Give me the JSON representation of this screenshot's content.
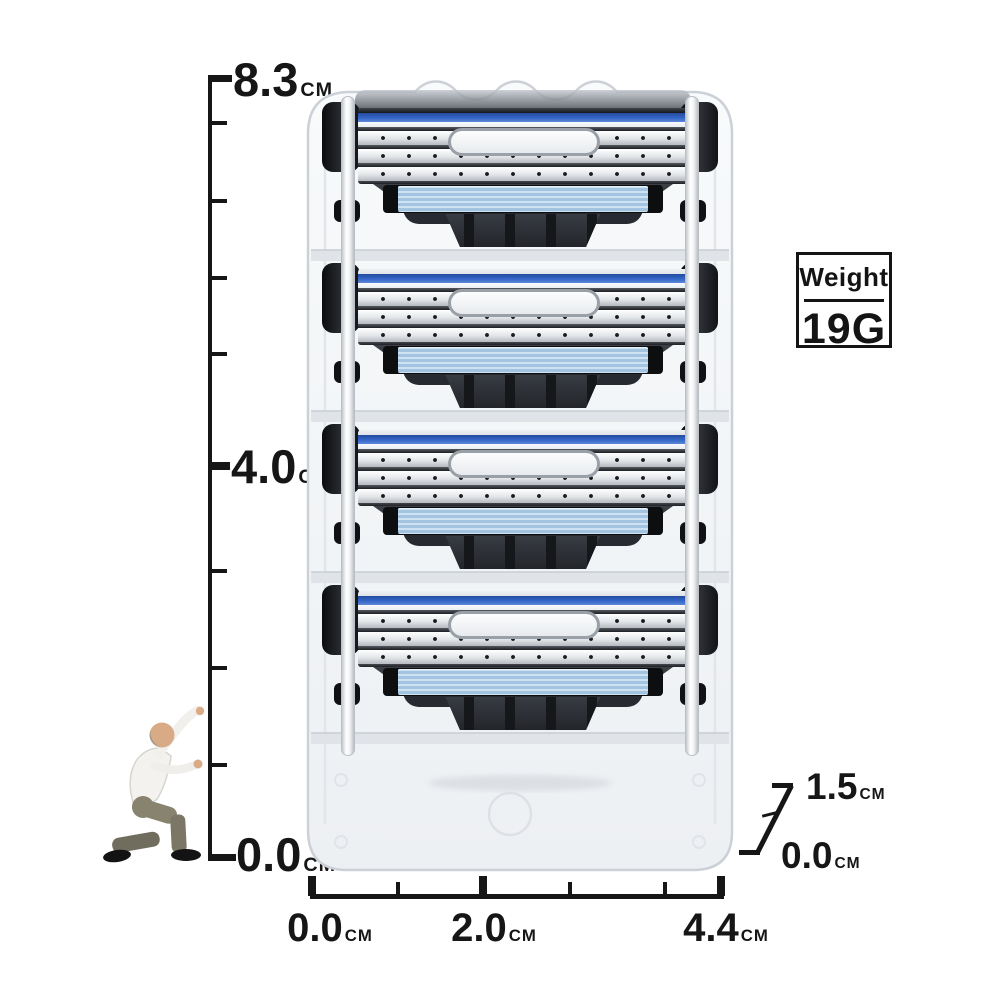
{
  "vertical_ruler": {
    "unit": "CM",
    "orientation": "vertical",
    "marks": [
      {
        "label": "8.3"
      },
      {
        "label": "4.0"
      },
      {
        "label": "0.0"
      }
    ]
  },
  "horizontal_ruler": {
    "unit": "CM",
    "orientation": "horizontal",
    "marks": [
      {
        "label": "0.0"
      },
      {
        "label": "2.0"
      },
      {
        "label": "4.4"
      }
    ]
  },
  "depth_ruler": {
    "unit": "CM",
    "orientation": "diagonal",
    "marks": [
      {
        "label": "1.5"
      },
      {
        "label": "0.0"
      }
    ]
  },
  "weight_badge": {
    "title": "Weight",
    "value": "19G"
  },
  "product": {
    "cartridge_count": 4,
    "colors": {
      "blade_stripe_blue": "#3566c8",
      "lubricating_strip_blue": "#b7d3e9",
      "connector_dark": "#2f333a",
      "blade_silver": "#d9dcdf",
      "cap_black": "#131418",
      "tray": "#f2f5f7"
    }
  },
  "measurements": {
    "height_cm": 8.3,
    "width_cm": 4.4,
    "depth_cm": 1.5,
    "weight": "19G"
  }
}
